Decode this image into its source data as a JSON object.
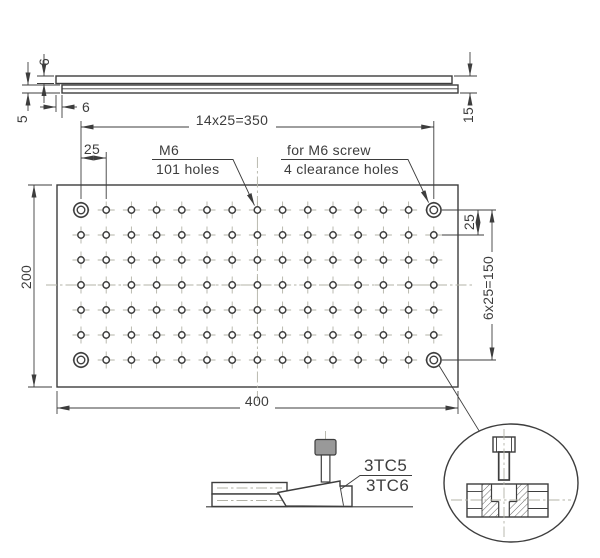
{
  "colors": {
    "line": "#3d3d3d",
    "light": "#b3b3a7",
    "screw_fill": "#999999",
    "bg": "#ffffff"
  },
  "side_view": {
    "dim_plate_thickness": "6",
    "dim_base_thickness": "5",
    "dim_edge_offset": "6",
    "dim_total_height": "15"
  },
  "top_view": {
    "dim_hole_span_x": "14x25=350",
    "dim_edge_margin": "25",
    "dim_row_pitch": "25",
    "dim_hole_span_y": "6x25=150",
    "dim_width": "400",
    "dim_height": "200",
    "note_thread": {
      "line1": "M6",
      "line2": "101 holes"
    },
    "note_clearance": {
      "line1": "for M6 screw",
      "line2": "4 clearance holes"
    },
    "grid": {
      "cols": 15,
      "rows": 7,
      "m6_holes": 101,
      "clearance_holes": 4
    }
  },
  "clamp_view": {
    "part_upper": "3TC5",
    "part_lower": "3TC6"
  }
}
